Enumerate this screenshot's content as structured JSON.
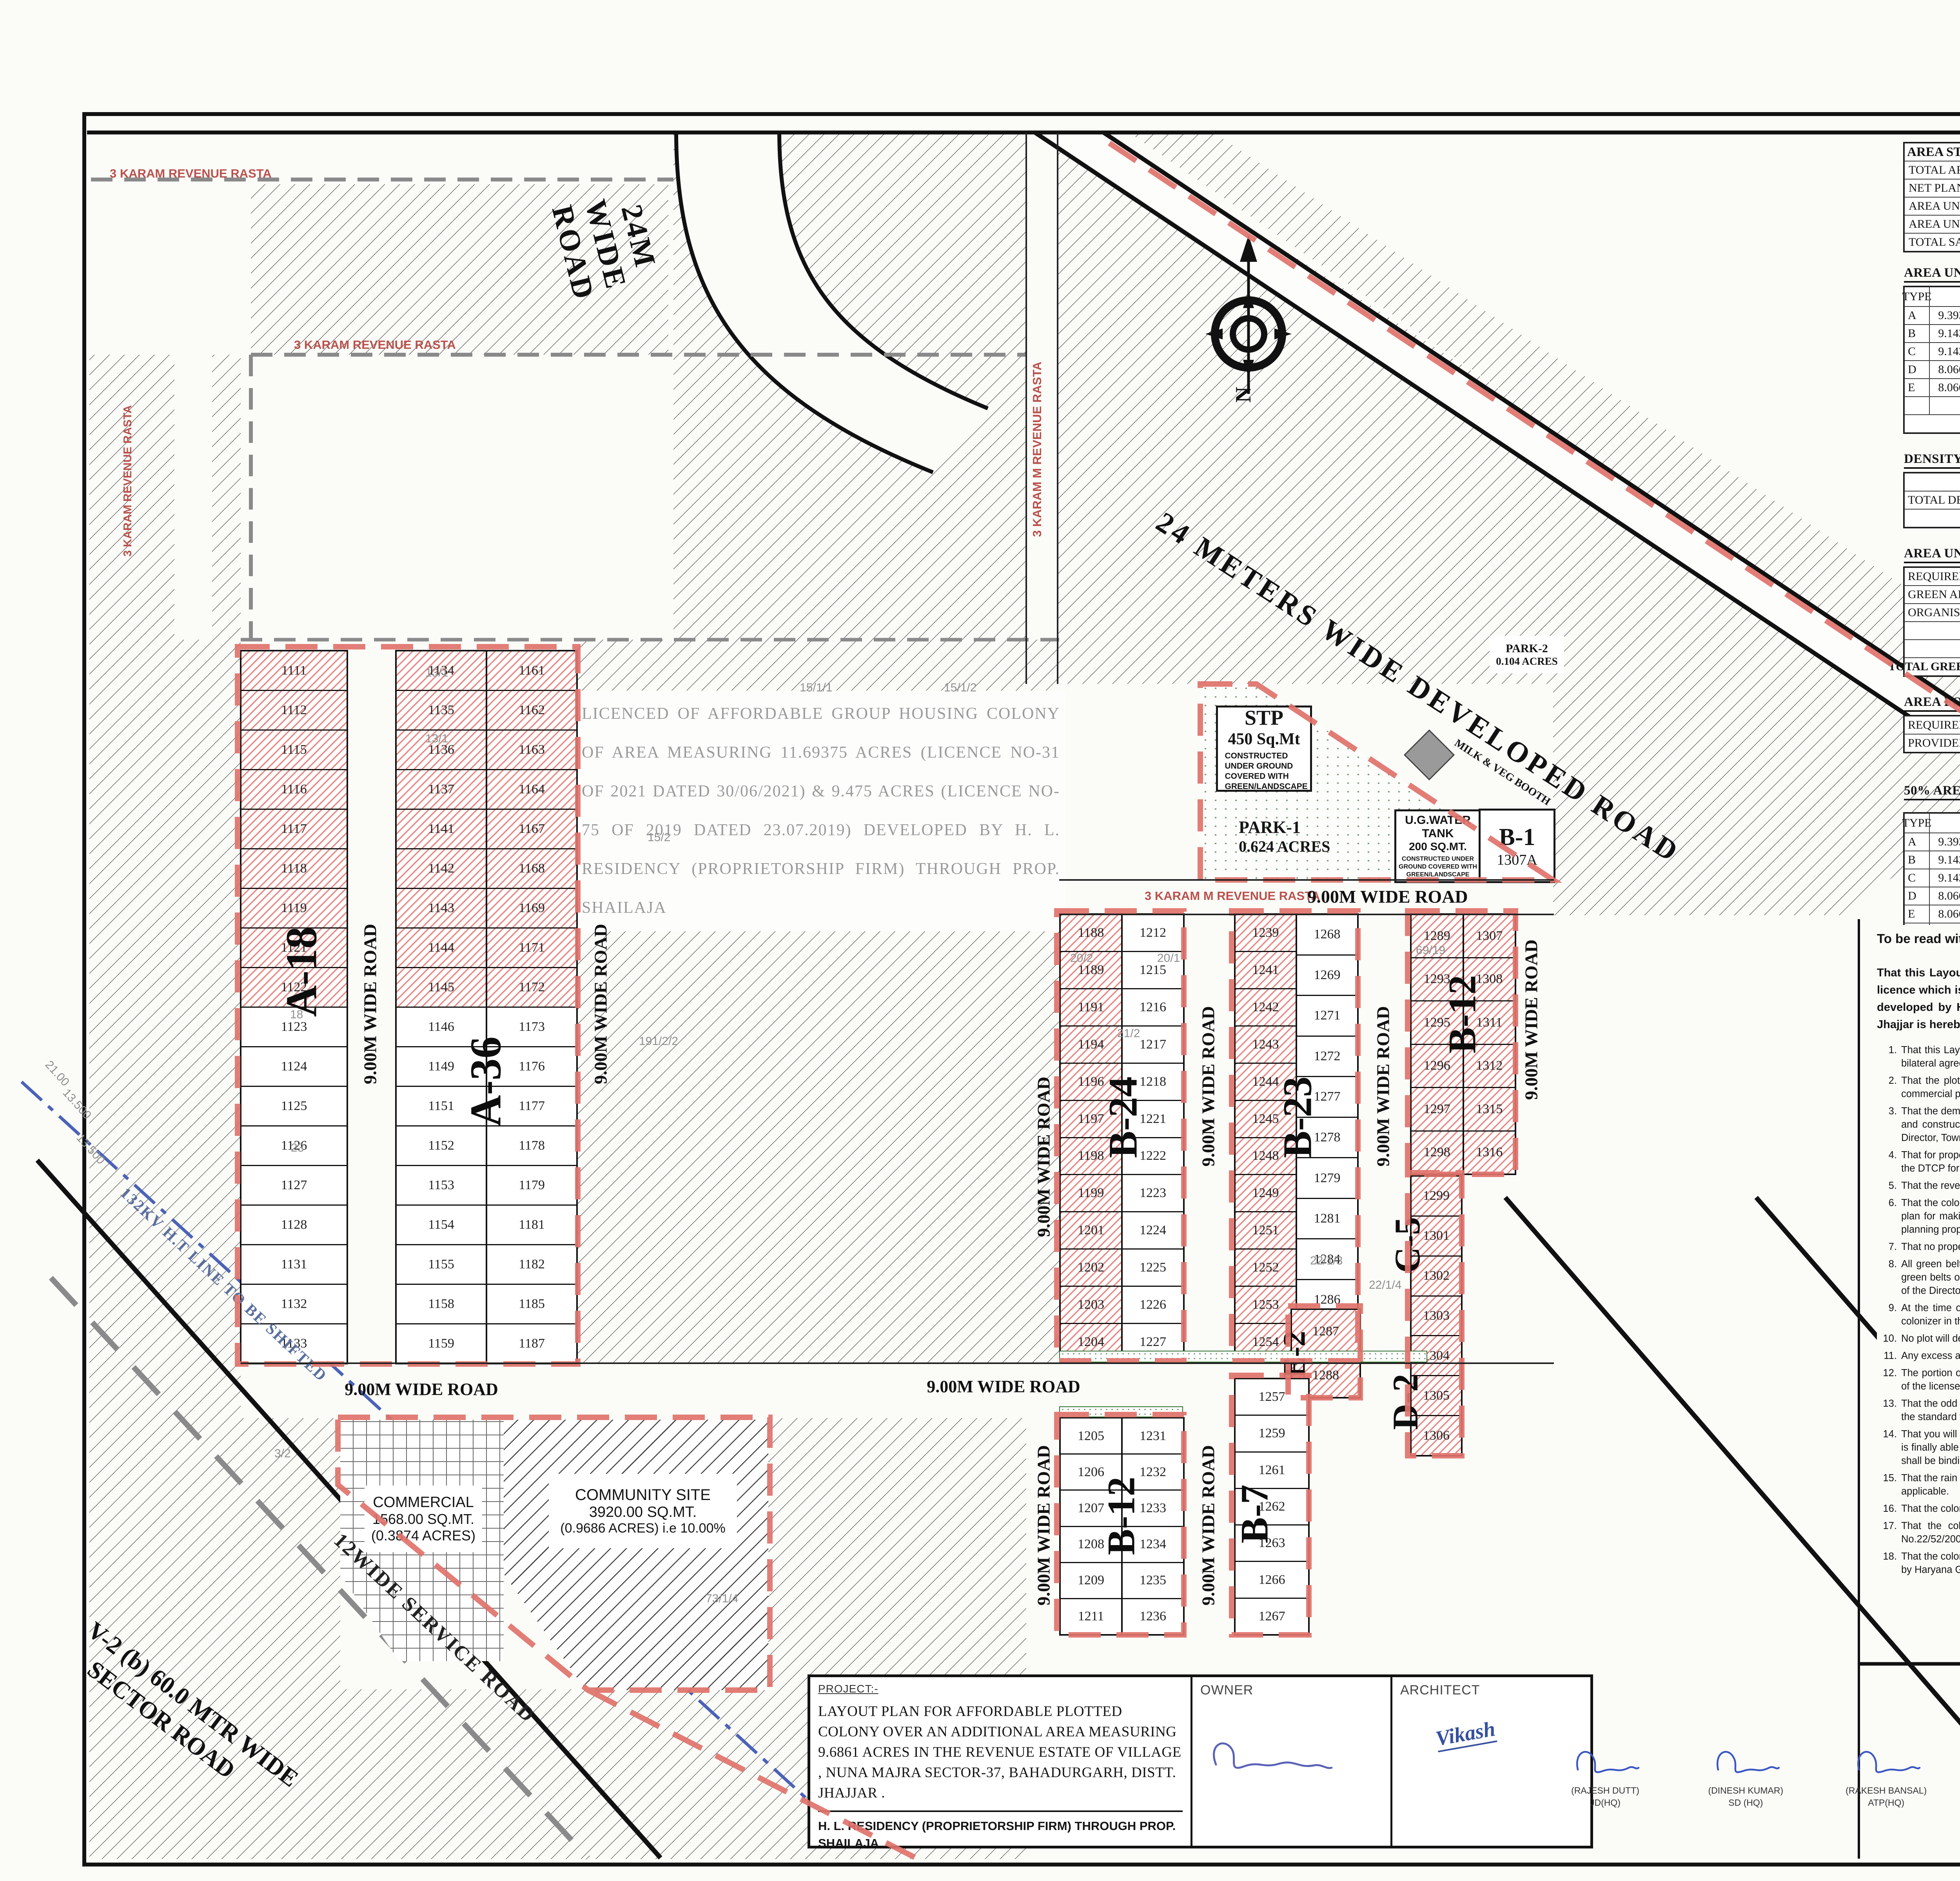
{
  "sheet_title": "LAYOUT PLAN FOR AFFORDABLE PLOTTED COLONY",
  "tables": {
    "area_statement": {
      "title": "AREA STATEMENT",
      "rows": [
        [
          "TOTAL AREA OF THE SCHEME",
          "=",
          "9.68610",
          "Acres",
          "",
          ""
        ],
        [
          "NET PLANNED AREA FOR PLANNING",
          "=",
          "9.6861",
          "Acres",
          "",
          ""
        ],
        [
          "AREA UNDER COMMERCIAL",
          "=",
          "0.3874",
          "Acres",
          "4.000",
          "%"
        ],
        [
          "AREA UNDER PLOTS",
          "=",
          "5.1184",
          "Acres",
          "52.842",
          "%"
        ],
        [
          "TOTAL SALEBLE AREA",
          "=",
          "5.506",
          "Acres",
          "56.842",
          "%"
        ]
      ]
    },
    "area_under_plots": {
      "title": "AREA UNDER PLOTS",
      "headers": [
        "TYPE",
        "SIZE",
        "AREA",
        "TOTAL PLOTS",
        "",
        "TOTAL AREA"
      ],
      "rows": [
        [
          "A",
          "9.393",
          "x",
          "15.420",
          "144.840",
          "54",
          "=",
          "7821.36",
          "Sq.Mt"
        ],
        [
          "B",
          "9.143",
          "x",
          "16.352",
          "149.506",
          "79",
          "=",
          "11811.00",
          "Sq.Mt"
        ],
        [
          "C",
          "9.143",
          "x",
          "13.212",
          "120.797",
          "5",
          "=",
          "603.99",
          "Sq.Mt"
        ],
        [
          "D",
          "8.066",
          "x",
          "13.212",
          "106.568",
          "2",
          "=",
          "213.14",
          "Sq.Mt"
        ],
        [
          "E",
          "8.066",
          "x",
          "16.352",
          "131.895",
          "2",
          "=",
          "263.79",
          "Sq.Mt"
        ],
        [
          "",
          "",
          "",
          "",
          "",
          "142",
          "=",
          "20713.277",
          "Sq.Mt"
        ]
      ],
      "or_label": "OR",
      "or_eq": "=",
      "or_value": "5.118",
      "or_unit": "Acres",
      "or_pct": "52.842",
      "pct_sign": "%"
    },
    "density": {
      "title": "DENSITY CALCULATION",
      "rows": [
        [
          "",
          "=",
          "142",
          "x",
          "18.00",
          "@  Person's per Plot"
        ],
        [
          "TOTAL DENSITY",
          "=",
          "2556",
          "÷",
          "9.6861",
          "Acres"
        ],
        [
          "",
          "=",
          "264",
          "PPA",
          "",
          "Against 240-400 PPA Minimmum required"
        ]
      ]
    },
    "green": {
      "title": "AREA UNDER GREEN",
      "required": {
        "label": "REQUIRED GREEN",
        "eq": "=",
        "value": "0.726",
        "unit": "Acres",
        "pct": "7.50%"
      },
      "provided_label": "GREEN AREA PROVIDED",
      "organised_label": "ORGANISED GREEN",
      "parks": [
        {
          "eq": "=",
          "name": "PARK-1",
          "eq2": "=",
          "value": "0.624",
          "unit": "Acres"
        },
        {
          "eq": "=",
          "name": "PARK-2",
          "eq2": "=",
          "value": "0.104",
          "unit": "Acres"
        },
        {
          "eq": "",
          "name": "",
          "eq2": "=",
          "value": "",
          "unit": ""
        }
      ],
      "total": {
        "label": "TOTAL GREEN PROVIDED",
        "eq": "=",
        "value": "0.728",
        "unit": "Acres",
        "pct": "7.",
        "pctsign": "%"
      }
    },
    "community": {
      "title": "AREA FOR PROVISION OF COMMUNITY FACILITIES",
      "rows": [
        [
          "REQUIRED AREA",
          "=",
          "0.9686",
          "Acres",
          "10.00%"
        ],
        [
          "PROVIDED AREA",
          "=",
          "0.9686",
          "Acres",
          "10.00%"
        ]
      ]
    },
    "freeze": {
      "title": "50% AREA FREEZE SHOWN THUS",
      "headers": [
        "TYPE",
        "SIZE",
        "AREA",
        "TOTAL PLOTS",
        "",
        "TOTAL AREA"
      ],
      "rows": [
        [
          "A",
          "9.393",
          "x",
          "15.420",
          "144.840",
          "27",
          "=",
          "3910.682",
          "Sq.Mt"
        ],
        [
          "B",
          "9.143",
          "x",
          "16.352",
          "149.506",
          "36",
          "=",
          "5382.228",
          "Sq.Mt"
        ],
        [
          "C",
          "9.143",
          "x",
          "13.212",
          "120.797",
          "5",
          "=",
          "603.987",
          "Sq.Mt"
        ],
        [
          "D",
          "8.066",
          "x",
          "13.212",
          "106.568",
          "2",
          "=",
          "213.136",
          "Sq.Mt"
        ],
        [
          "E",
          "8.066",
          "x",
          "16.352",
          "131.895",
          "2",
          "=",
          "263.790",
          "Sq.Mt"
        ],
        [
          "",
          "",
          "",
          "",
          "",
          "72",
          "=",
          "10373.823",
          "Sq.Mt"
        ]
      ],
      "or_label": "OR",
      "or_eq": "=",
      "or_value": "2.563",
      "or_unit": "Acres",
      "or_pct": "50.086",
      "pct_sign": "%"
    }
  },
  "licence": {
    "prefix": "To be read with Licence No.",
    "no": "69.",
    "mid": "of 2021   Dated",
    "date": "17/09/2021.",
    "code": "LC- 3982-E"
  },
  "para": {
    "p1": "That this Layout plan for an area measuring 9.6861 acres (Drawing No. ",
    "hw1": "7910",
    "p2": "  Dated ",
    "hw2": "20-09-21",
    "p3": " ) comprised of licence which is issued in respect of Affordable Plotted Colony (Under Deen Dayal Jan Awas Yojna-2016) being developed by H.L. Residency (Proprietorship Firm) through Prop. Shailaja., Sector-37, Bahadurgarh, District Jhajjar is hereby approved subject to the following conditions:-"
  },
  "conditions": [
    "That this Layout Plan shall be read in conjunction with the clauses appearing on the agreement executed under Rule 11 and the bilateral agreement.",
    "That the plotted area of the colony shall not exceed 65% of the net planned area of the colony. The entire area reserved for commercial purposes shall be taken as plotted for calculation of the area under plots.",
    "That the demarcation plans as per site of all the Residential Plots and Commercial site shall be got approved from this Department and construction on these sites shall be governed by the Haryana Building Code, 2017 and the zoning Plan approved by the Director, Town & Country Planning, Haryana.",
    "That for proper planning and integration of services in the area adjacent to the colony, the colonizer shall abide by the directions of the DTCP for the modification of layout plans of the colony.",
    "That the revenue rasta falling in the colony shall be kept free for circulation/movement as shown in the layout plan.",
    "That the colonizer shall abide by the directions of the DTCP, Haryana and accordingly shall make necessary changes in the layout plan for making any adjustment in the alignment of the peripheral roads, internal road circulation or for proper integration of the planning proposals of the adjoining areas.",
    "That no property/plot shall derive access directly from the carriage way of 30 metres or wider sector road if applicable.",
    "All green belts provided in the layout plan within the licenced areas of the colony shall be developed by the colonizer. All other green belts outside the licenced area shall be developed by the Haryana Urban Development Authority/colonizer on the directions of the Director, Town and Country planning, Haryana or in accordance with terms and conditions of the  agreements of the licence.",
    "At the time of demarcation plan, if required percentage of organized open space is reduced, the same will be provided by the colonizer in the licenced area.",
    "No plot will derive an access from less than 9 metres wide road would mean a minimum clear width of 9 metres between the plots.",
    "Any excess area over and above the permissible 4% under commercial use shall be deemed to be open space.",
    "The portion of the sector/development plan roads /green belts as provided in the Development Plan if applicable, which form part of the licensed area shall be transferred free of cost to the government on the lines of Section 3(3)(a)(iii) of the Act No.8 of 1975.",
    "That the odd size plots are being approved subject to the conditions that these plots should not have a frontage of less than 75% of the standard frontage when demarcated.",
    "That you will have no objection to the regularization of the boundaries of the licence through give and take with the land that HSVP is finally able to acquire in the interest of planned development and integration of services. The decision of the competent authority shall be binding in this regard.",
    "That the rain water harvesting system shall be provided as per Central Ground Water Authority norms/Haryana Govt. notification as applicable.",
    "That the colonizer/owner shall use only Light-Emitting Diode lamps (LED) fitting for internal lighting as well as Campus lighting.",
    "That the colonizer/owner shall ensure the installation of Solar Photovoltaic Power Plant as per the provisions of order No.22/52/2005-5Power dated 21.03.2016 issued by Haryana Government Renewable Energy Department.",
    "That the colonizer/owner shall strictly comply with the directions issued vide Notification No. 19/6/2016-5P dated 31.03.2016 issued by Haryana Government Renewable Energy Department for enforcement of the Energy Conservation Building Codes."
  ],
  "title_block": {
    "project_label": "PROJECT:-",
    "project_text": "LAYOUT PLAN FOR AFFORDABLE PLOTTED  COLONY OVER AN ADDITIONAL AREA MEASURING 9.6861 ACRES  IN THE REVENUE ESTATE OF VILLAGE , NUNA MAJRA SECTOR-37, BAHADURGARH, DISTT. JHAJJAR .",
    "developer": "H. L. RESIDENCY (PROPRIETORSHIP FIRM) THROUGH PROP. SHAILAJA",
    "owner_label": "OWNER",
    "architect_label": "ARCHITECT",
    "architect_sig": "Vikash",
    "signatories": [
      {
        "name": "(RAJESH DUTT)",
        "title": "JD(HQ)",
        "ink": "#3a56c4"
      },
      {
        "name": "(DINESH KUMAR)",
        "title": "SD (HQ)",
        "ink": "#3a56c4"
      },
      {
        "name": "(RAKESH BANSAL)",
        "title": "ATP(HQ)",
        "ink": "#3a56c4"
      },
      {
        "name": "(BABITA GUPTA)",
        "title": "DTP(HQ)",
        "ink": "#3a56c4"
      },
      {
        "name": "(HITESH SHARMA)",
        "title": "STP HQ",
        "ink": "#2a2a2a"
      },
      {
        "name": "(P P SINGH)",
        "title": "CTP (HR)",
        "ink": "#2a2a2a"
      },
      {
        "name": "(K. MAKRAND PANDURANG, IAS)",
        "title": "DTCP (HR)",
        "ink": "#2a2a2a"
      }
    ]
  },
  "plan": {
    "road_label": "9.00M WIDE ROAD",
    "road_24m": "24M WIDE ROAD",
    "road_24_dev": "24 METERS WIDE DEVELOPED ROAD",
    "rasta_label": "3 KARAM REVENUE RASTA",
    "rasta_m_label": "3 KARAM M REVENUE RASTA",
    "service_road": "12WIDE SERVICE ROAD",
    "sector_road_1": "V-2 (b) 60.0 MTR WIDE",
    "sector_road_2": "SECTOR ROAD",
    "ht_line": "132KV H.T LINE TO BE SHIFTED",
    "compass_n": "N",
    "watermark": "LICENCED  OF  AFFORDABLE  GROUP  HOUSING  COLONY  OF  AREA MEASURING  11.69375  ACRES  (LICENCE  NO-31  OF  2021  DATED 30/06/2021)  &  9.475  ACRES  (LICENCE  NO-75  OF  2019  DATED 23.07.2019)  DEVELOPED  BY  H.  L.  RESIDENCY  (PROPRIETORSHIP  FIRM) THROUGH PROP. SHAILAJA",
    "stp": {
      "l1": "STP",
      "l2": "450 Sq.Mt",
      "l3": "CONSTRUCTED UNDER GROUND COVERED WITH GREEN/LANDSCAPE"
    },
    "park1": {
      "l1": "PARK-1",
      "l2": "0.624 ACRES"
    },
    "park2": {
      "l1": "PARK-2",
      "l2": "0.104 ACRES"
    },
    "milk_booth": "MILK & VEG BOOTH",
    "ug_tank": {
      "l1": "U.G.WATER TANK",
      "l2": "200 SQ.MT.",
      "l3": "CONSTRUCTED UNDER GROUND COVERED WITH GREEN/LANDSCAPE"
    },
    "b1": {
      "l1": "B-1",
      "l2": "1307A"
    },
    "commercial": {
      "l1": "COMMERCIAL",
      "l2": "1568.00 SQ.MT.",
      "l3": "(0.3874 ACRES)"
    },
    "community": {
      "l1": "COMMUNITY SITE",
      "l2": "3920.00 SQ.MT.",
      "l3": "(0.9686 ACRES) i.e 10.00%"
    },
    "blocks": {
      "a18": {
        "label": "A-18",
        "plots": [
          "1111",
          "1112",
          "1115",
          "1116",
          "1117",
          "1118",
          "1119",
          "1121",
          "1122",
          "1123",
          "1124",
          "1125",
          "1126",
          "1127",
          "1128",
          "1131",
          "1132",
          "1133"
        ]
      },
      "a36L": {
        "plots": [
          "1134",
          "1135",
          "1136",
          "1137",
          "1141",
          "1142",
          "1143",
          "1144",
          "1145",
          "1146",
          "1149",
          "1151",
          "1152",
          "1153",
          "1154",
          "1155",
          "1158",
          "1159"
        ]
      },
      "a36R": {
        "label": "A-36",
        "plots": [
          "1161",
          "1162",
          "1163",
          "1164",
          "1167",
          "1168",
          "1169",
          "1171",
          "1172",
          "1173",
          "1176",
          "1177",
          "1178",
          "1179",
          "1181",
          "1182",
          "1185",
          "1187"
        ]
      },
      "b24L": {
        "label": "B-24",
        "plots": [
          "1188",
          "1189",
          "1191",
          "1194",
          "1196",
          "1197",
          "1198",
          "1199",
          "1201",
          "1202",
          "1203",
          "1204"
        ]
      },
      "b24R": {
        "plots": [
          "1212",
          "1215",
          "1216",
          "1217",
          "1218",
          "1221",
          "1222",
          "1223",
          "1224",
          "1225",
          "1226",
          "1227"
        ]
      },
      "b23L": {
        "label": "B-23",
        "plots": [
          "1239",
          "1241",
          "1242",
          "1243",
          "1244",
          "1245",
          "1248",
          "1249",
          "1251",
          "1252",
          "1253",
          "1254"
        ]
      },
      "b23R": {
        "plots": [
          "1268",
          "1269",
          "1271",
          "1272",
          "1277",
          "1278",
          "1279",
          "1281",
          "1284",
          "1286",
          "1111"
        ]
      },
      "b12uL": {
        "label": "B-12",
        "plots": [
          "1289",
          "1293",
          "1295",
          "1296",
          "1297",
          "1298"
        ]
      },
      "b12uR": {
        "plots": [
          "1307",
          "1308",
          "1311",
          "1312",
          "1315",
          "1316"
        ]
      },
      "c5d2": {
        "label_c": "C-5",
        "label_d": "D-2",
        "plots": [
          "1299",
          "1301",
          "1302",
          "1303",
          "1304",
          "1305",
          "1306"
        ]
      },
      "e2": {
        "label": "E-2",
        "plots": [
          "1287",
          "1288"
        ]
      },
      "b12lL": {
        "label": "B-12",
        "plots": [
          "1205",
          "1206",
          "1207",
          "1208",
          "1209",
          "1211"
        ]
      },
      "b12lR": {
        "plots": [
          "1231",
          "1232",
          "1233",
          "1234",
          "1235",
          "1236"
        ]
      },
      "b7": {
        "label": "B-7",
        "plots": [
          "1257",
          "1259",
          "1261",
          "1262",
          "1263",
          "1266",
          "1267"
        ]
      }
    },
    "survey_numbers": [
      "13/1",
      "13/1",
      "15/1/1",
      "15/1/2",
      "15/2",
      "191/2/2",
      "20/2",
      "20/1",
      "21/2",
      "22/1/3",
      "22/1/4",
      "69/19",
      "73/1/4",
      "3/2",
      "18",
      "23",
      "13.500",
      "13.500",
      "21.00"
    ]
  }
}
